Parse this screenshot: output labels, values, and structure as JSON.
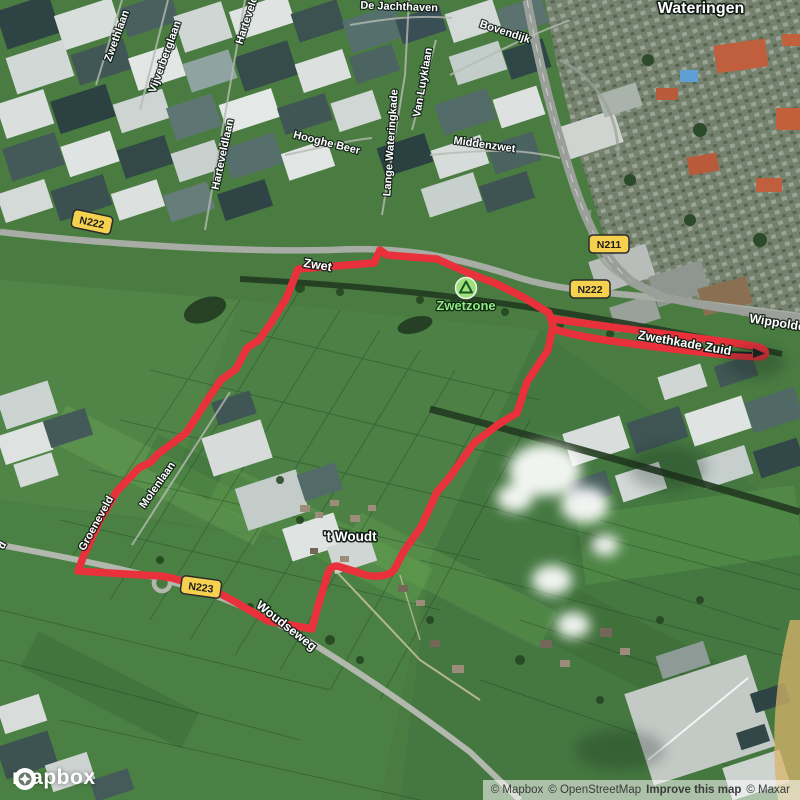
{
  "map": {
    "place_labels": [
      {
        "text": "Wateringen"
      },
      {
        "text": "'t Woudt"
      }
    ],
    "road_labels": [
      {
        "text": "Zwethlaan"
      },
      {
        "text": "Vijverberglaan"
      },
      {
        "text": "Harteveld"
      },
      {
        "text": "Harteveldlaan"
      },
      {
        "text": "Hooghe Beer"
      },
      {
        "text": "Lange Wateringkade"
      },
      {
        "text": "De Jachthaven"
      },
      {
        "text": "Bovendijk"
      },
      {
        "text": "Van Luyklaan"
      },
      {
        "text": "Middenzwet"
      },
      {
        "text": "Zwet"
      },
      {
        "text": "Wippolder"
      },
      {
        "text": "Zwethkade Zuid"
      },
      {
        "text": "Groeneveld"
      },
      {
        "text": "Molenlaan"
      },
      {
        "text": "Woudseweg"
      },
      {
        "text": "d"
      }
    ],
    "route_shields": [
      {
        "text": "N222"
      },
      {
        "text": "N211"
      },
      {
        "text": "N222"
      },
      {
        "text": "N223"
      }
    ],
    "poi_labels": [
      {
        "text": "Zwetzone",
        "icon": "park-icon"
      }
    ],
    "route": {
      "color": "#e8313b"
    },
    "shield_color": "#f6d14f"
  },
  "branding": {
    "wordmark": "mapbox"
  },
  "attribution": {
    "mapbox": "© Mapbox",
    "osm": "© OpenStreetMap",
    "improve": "Improve this map",
    "maxar": "© Maxar"
  }
}
